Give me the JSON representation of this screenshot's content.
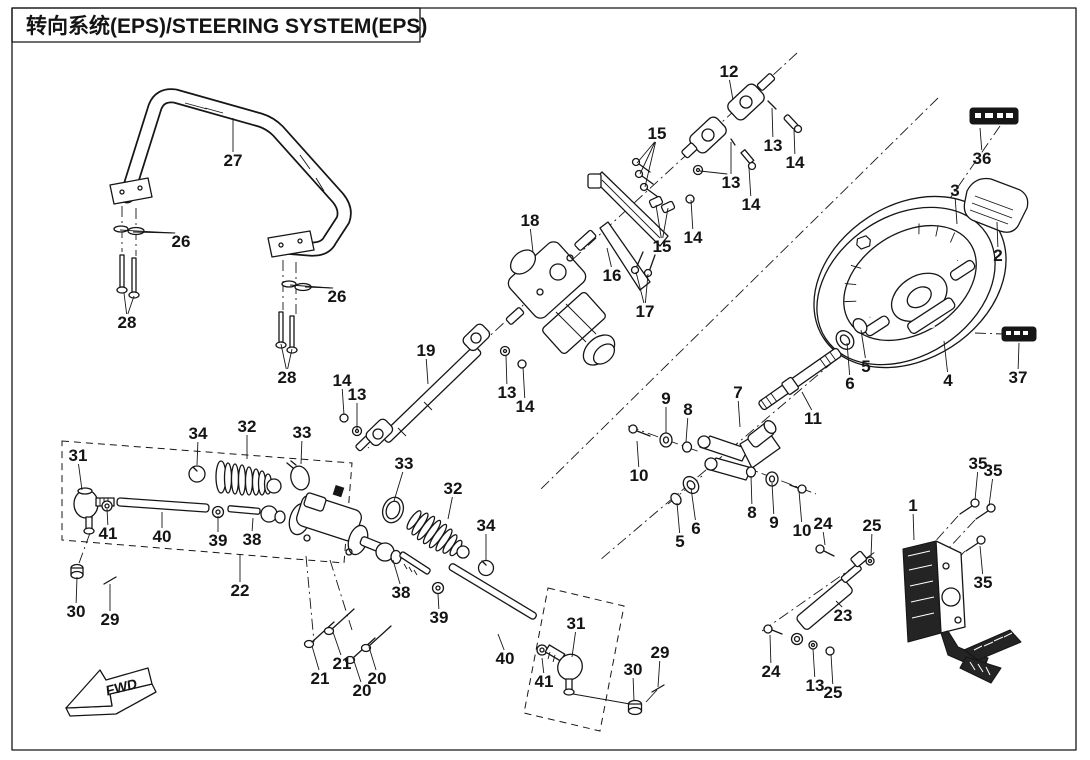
{
  "title": "转向系统(EPS)/STEERING SYSTEM(EPS)",
  "fwd_label": "FWD",
  "colors": {
    "ink": "#161616",
    "background": "#ffffff"
  },
  "stickers": [
    {
      "name": "sticker-36",
      "style": "black-label"
    },
    {
      "name": "sticker-37",
      "style": "black-label"
    }
  ],
  "parts": [
    {
      "n": "27",
      "x": 233,
      "y": 160,
      "t": [
        [
          233,
          118
        ]
      ]
    },
    {
      "n": "26",
      "x": 181,
      "y": 241,
      "t": [
        [
          133,
          232
        ],
        [
          120,
          230
        ]
      ]
    },
    {
      "n": "28",
      "x": 127,
      "y": 322,
      "t": [
        [
          124,
          293
        ],
        [
          134,
          296
        ]
      ]
    },
    {
      "n": "26",
      "x": 337,
      "y": 296,
      "t": [
        [
          305,
          287
        ],
        [
          290,
          285
        ]
      ]
    },
    {
      "n": "28",
      "x": 287,
      "y": 377,
      "t": [
        [
          281,
          344
        ],
        [
          292,
          349
        ]
      ]
    },
    {
      "n": "12",
      "x": 729,
      "y": 71,
      "t": [
        [
          733,
          100
        ]
      ]
    },
    {
      "n": "15",
      "x": 657,
      "y": 133,
      "t": [
        [
          637,
          163
        ],
        [
          640,
          174
        ],
        [
          645,
          187
        ]
      ]
    },
    {
      "n": "13",
      "x": 773,
      "y": 145,
      "t": [
        [
          772,
          108
        ]
      ]
    },
    {
      "n": "14",
      "x": 795,
      "y": 162,
      "t": [
        [
          794,
          130
        ]
      ]
    },
    {
      "n": "13",
      "x": 731,
      "y": 182,
      "t": [
        [
          700,
          171
        ],
        [
          731,
          142
        ]
      ]
    },
    {
      "n": "14",
      "x": 751,
      "y": 204,
      "t": [
        [
          749,
          168
        ]
      ]
    },
    {
      "n": "14",
      "x": 693,
      "y": 237,
      "t": [
        [
          691,
          200
        ]
      ]
    },
    {
      "n": "16",
      "x": 612,
      "y": 275,
      "t": [
        [
          607,
          248
        ]
      ]
    },
    {
      "n": "15",
      "x": 662,
      "y": 246,
      "t": [
        [
          656,
          205
        ],
        [
          668,
          208
        ]
      ]
    },
    {
      "n": "17",
      "x": 645,
      "y": 311,
      "t": [
        [
          636,
          272
        ],
        [
          648,
          274
        ]
      ]
    },
    {
      "n": "18",
      "x": 530,
      "y": 220,
      "t": [
        [
          533,
          252
        ]
      ]
    },
    {
      "n": "19",
      "x": 426,
      "y": 350,
      "t": [
        [
          428,
          384
        ]
      ]
    },
    {
      "n": "14",
      "x": 342,
      "y": 380,
      "t": [
        [
          344,
          415
        ]
      ]
    },
    {
      "n": "13",
      "x": 357,
      "y": 394,
      "t": [
        [
          357,
          429
        ]
      ]
    },
    {
      "n": "13",
      "x": 507,
      "y": 392,
      "t": [
        [
          506,
          356
        ]
      ]
    },
    {
      "n": "14",
      "x": 525,
      "y": 406,
      "t": [
        [
          523,
          367
        ]
      ]
    },
    {
      "n": "36",
      "x": 982,
      "y": 158,
      "t": [
        [
          980,
          128
        ]
      ]
    },
    {
      "n": "3",
      "x": 955,
      "y": 190,
      "t": [
        [
          957,
          224
        ]
      ]
    },
    {
      "n": "2",
      "x": 998,
      "y": 255,
      "t": [
        [
          997,
          222
        ]
      ]
    },
    {
      "n": "4",
      "x": 948,
      "y": 380,
      "t": [
        [
          944,
          341
        ]
      ]
    },
    {
      "n": "37",
      "x": 1018,
      "y": 377,
      "t": [
        [
          1019,
          343
        ]
      ]
    },
    {
      "n": "5",
      "x": 866,
      "y": 366,
      "t": [
        [
          861,
          330
        ]
      ]
    },
    {
      "n": "6",
      "x": 850,
      "y": 383,
      "t": [
        [
          847,
          343
        ]
      ]
    },
    {
      "n": "11",
      "x": 813,
      "y": 418,
      "t": [
        [
          802,
          392
        ]
      ]
    },
    {
      "n": "7",
      "x": 738,
      "y": 392,
      "t": [
        [
          740,
          427
        ]
      ]
    },
    {
      "n": "9",
      "x": 666,
      "y": 398,
      "t": [
        [
          666,
          433
        ]
      ]
    },
    {
      "n": "8",
      "x": 688,
      "y": 409,
      "t": [
        [
          686,
          442
        ]
      ]
    },
    {
      "n": "10",
      "x": 639,
      "y": 475,
      "t": [
        [
          637,
          441
        ]
      ]
    },
    {
      "n": "5",
      "x": 680,
      "y": 541,
      "t": [
        [
          677,
          503
        ]
      ]
    },
    {
      "n": "6",
      "x": 696,
      "y": 528,
      "t": [
        [
          691,
          488
        ]
      ]
    },
    {
      "n": "8",
      "x": 752,
      "y": 512,
      "t": [
        [
          751,
          476
        ]
      ]
    },
    {
      "n": "9",
      "x": 774,
      "y": 522,
      "t": [
        [
          772,
          483
        ]
      ]
    },
    {
      "n": "10",
      "x": 802,
      "y": 530,
      "t": [
        [
          799,
          491
        ]
      ]
    },
    {
      "n": "24",
      "x": 823,
      "y": 523,
      "t": [
        [
          825,
          545
        ]
      ]
    },
    {
      "n": "25",
      "x": 872,
      "y": 525,
      "t": [
        [
          871,
          557
        ]
      ]
    },
    {
      "n": "23",
      "x": 843,
      "y": 615,
      "t": [
        [
          836,
          601
        ]
      ]
    },
    {
      "n": "24",
      "x": 771,
      "y": 671,
      "t": [
        [
          770,
          635
        ]
      ]
    },
    {
      "n": "13",
      "x": 815,
      "y": 685,
      "t": [
        [
          813,
          649
        ]
      ]
    },
    {
      "n": "25",
      "x": 833,
      "y": 692,
      "t": [
        [
          831,
          654
        ]
      ]
    },
    {
      "n": "1",
      "x": 913,
      "y": 505,
      "t": [
        [
          914,
          540
        ]
      ]
    },
    {
      "n": "35",
      "x": 978,
      "y": 463,
      "t": [
        [
          975,
          500
        ]
      ]
    },
    {
      "n": "35",
      "x": 993,
      "y": 470,
      "t": [
        [
          989,
          506
        ]
      ]
    },
    {
      "n": "35",
      "x": 983,
      "y": 582,
      "t": [
        [
          980,
          546
        ]
      ]
    },
    {
      "n": "31",
      "x": 78,
      "y": 455,
      "t": [
        [
          82,
          490
        ]
      ]
    },
    {
      "n": "34",
      "x": 198,
      "y": 433,
      "t": [
        [
          197,
          465
        ]
      ]
    },
    {
      "n": "32",
      "x": 247,
      "y": 426,
      "t": [
        [
          247,
          459
        ]
      ]
    },
    {
      "n": "33",
      "x": 302,
      "y": 432,
      "t": [
        [
          301,
          464
        ]
      ]
    },
    {
      "n": "41",
      "x": 108,
      "y": 533,
      "t": [
        [
          107,
          509
        ]
      ]
    },
    {
      "n": "40",
      "x": 162,
      "y": 536,
      "t": [
        [
          162,
          512
        ]
      ]
    },
    {
      "n": "39",
      "x": 218,
      "y": 540,
      "t": [
        [
          218,
          516
        ]
      ]
    },
    {
      "n": "38",
      "x": 252,
      "y": 539,
      "t": [
        [
          253,
          518
        ]
      ]
    },
    {
      "n": "22",
      "x": 240,
      "y": 590,
      "t": [
        [
          240,
          554
        ]
      ]
    },
    {
      "n": "30",
      "x": 76,
      "y": 611,
      "t": [
        [
          77,
          577
        ]
      ]
    },
    {
      "n": "29",
      "x": 110,
      "y": 619,
      "t": [
        [
          110,
          584
        ]
      ]
    },
    {
      "n": "33",
      "x": 404,
      "y": 463,
      "t": [
        [
          394,
          501
        ]
      ]
    },
    {
      "n": "32",
      "x": 453,
      "y": 488,
      "t": [
        [
          448,
          519
        ]
      ]
    },
    {
      "n": "34",
      "x": 486,
      "y": 525,
      "t": [
        [
          486,
          561
        ]
      ]
    },
    {
      "n": "38",
      "x": 401,
      "y": 592,
      "t": [
        [
          393,
          560
        ]
      ]
    },
    {
      "n": "39",
      "x": 439,
      "y": 617,
      "t": [
        [
          438,
          594
        ]
      ]
    },
    {
      "n": "40",
      "x": 505,
      "y": 658,
      "t": [
        [
          498,
          634
        ]
      ]
    },
    {
      "n": "41",
      "x": 544,
      "y": 681,
      "t": [
        [
          542,
          658
        ]
      ]
    },
    {
      "n": "31",
      "x": 576,
      "y": 623,
      "t": [
        [
          572,
          657
        ]
      ]
    },
    {
      "n": "21",
      "x": 320,
      "y": 678,
      "t": [
        [
          312,
          646
        ]
      ]
    },
    {
      "n": "21",
      "x": 342,
      "y": 663,
      "t": [
        [
          333,
          632
        ]
      ]
    },
    {
      "n": "20",
      "x": 362,
      "y": 690,
      "t": [
        [
          353,
          658
        ]
      ]
    },
    {
      "n": "20",
      "x": 377,
      "y": 678,
      "t": [
        [
          369,
          647
        ]
      ]
    },
    {
      "n": "30",
      "x": 633,
      "y": 669,
      "t": [
        [
          634,
          701
        ]
      ]
    },
    {
      "n": "29",
      "x": 660,
      "y": 652,
      "t": [
        [
          658,
          687
        ]
      ]
    }
  ]
}
